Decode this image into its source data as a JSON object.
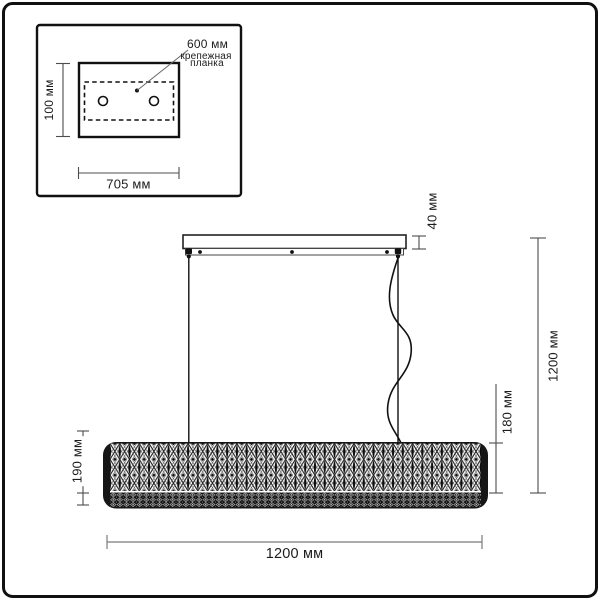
{
  "colors": {
    "line": "#1c1c1c",
    "dim_line": "#4d4d4d",
    "dim_line_light": "#7a7a7a",
    "shade_dark": "#141414",
    "background": "#ffffff"
  },
  "inset": {
    "plate_leader_label": "600 мм",
    "plate_name_line1": "крепежная",
    "plate_name_line2": "планка",
    "height_label": "100 мм",
    "width_label": "705 мм"
  },
  "main": {
    "canopy_height_label": "40 мм",
    "overall_height_label": "1200 мм",
    "shade_body_height_label": "180 мм",
    "shade_height_label": "190 мм",
    "overall_width_label": "1200 мм"
  }
}
